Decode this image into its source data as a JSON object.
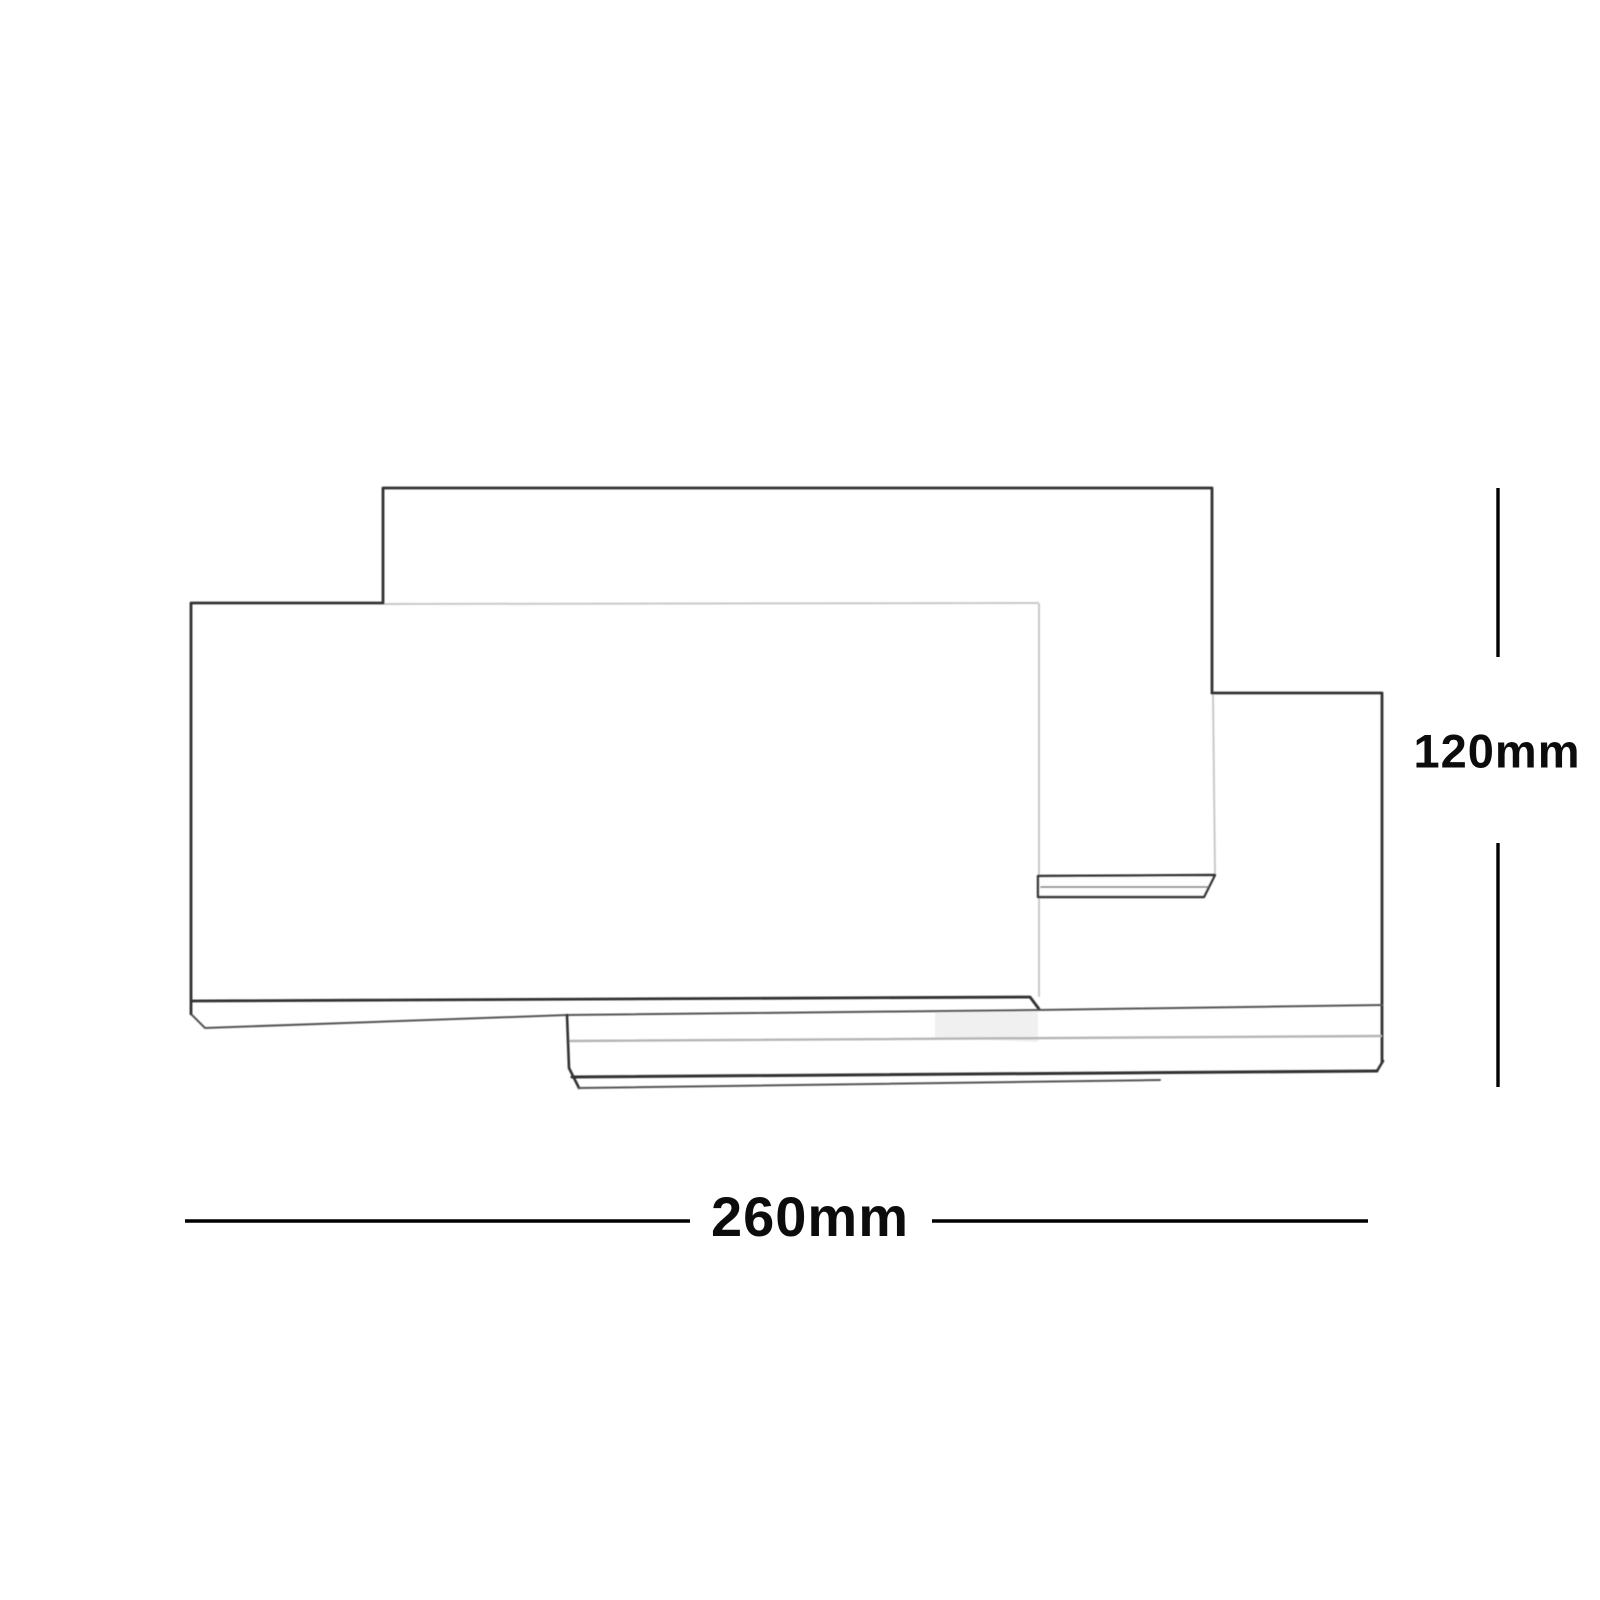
{
  "diagram": {
    "description": "Line-art dimension drawing of a wall light made of three overlapping rectangular panels",
    "dimensions": {
      "width": {
        "label": "260mm",
        "value": 260,
        "unit": "mm",
        "orientation": "horizontal"
      },
      "height": {
        "label": "120mm",
        "value": 120,
        "unit": "mm",
        "orientation": "vertical"
      }
    },
    "colors": {
      "background": "#ffffff",
      "outline_dark": "#333333",
      "outline_medium": "#555555",
      "outline_faint": "#c9c9c9",
      "seam_gray": "#b5b5b5",
      "ledge_fill": "#fdfdfd",
      "shadow": "#e4e4e4",
      "dimension_line": "#000000",
      "label_text": "#0c0c0c"
    }
  }
}
